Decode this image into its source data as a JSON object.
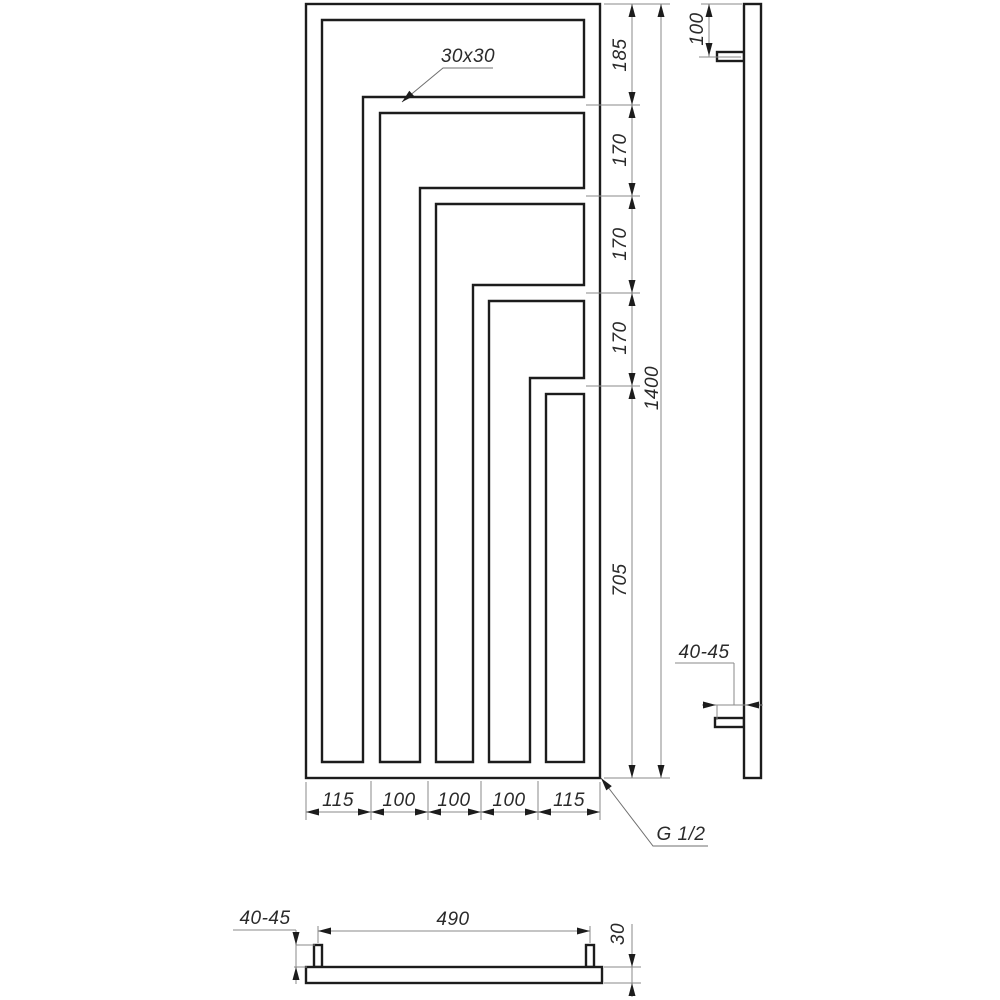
{
  "colors": {
    "line": "#1c1c1c",
    "thin_line": "#8a8a8a",
    "text": "#2a2a2a",
    "background": "#ffffff"
  },
  "front_view": {
    "profile_label": "30x30",
    "thread_label": "G 1/2",
    "height_segments": [
      "185",
      "170",
      "170",
      "170",
      "705"
    ],
    "overall_height": "1400",
    "width_segments": [
      "115",
      "100",
      "100",
      "100",
      "115"
    ]
  },
  "side_view": {
    "connector_offset_top": "100",
    "wall_bracket_range": "40-45"
  },
  "bottom_view": {
    "connector_height_range": "40-45",
    "connector_spacing": "490",
    "tube_depth": "30"
  }
}
